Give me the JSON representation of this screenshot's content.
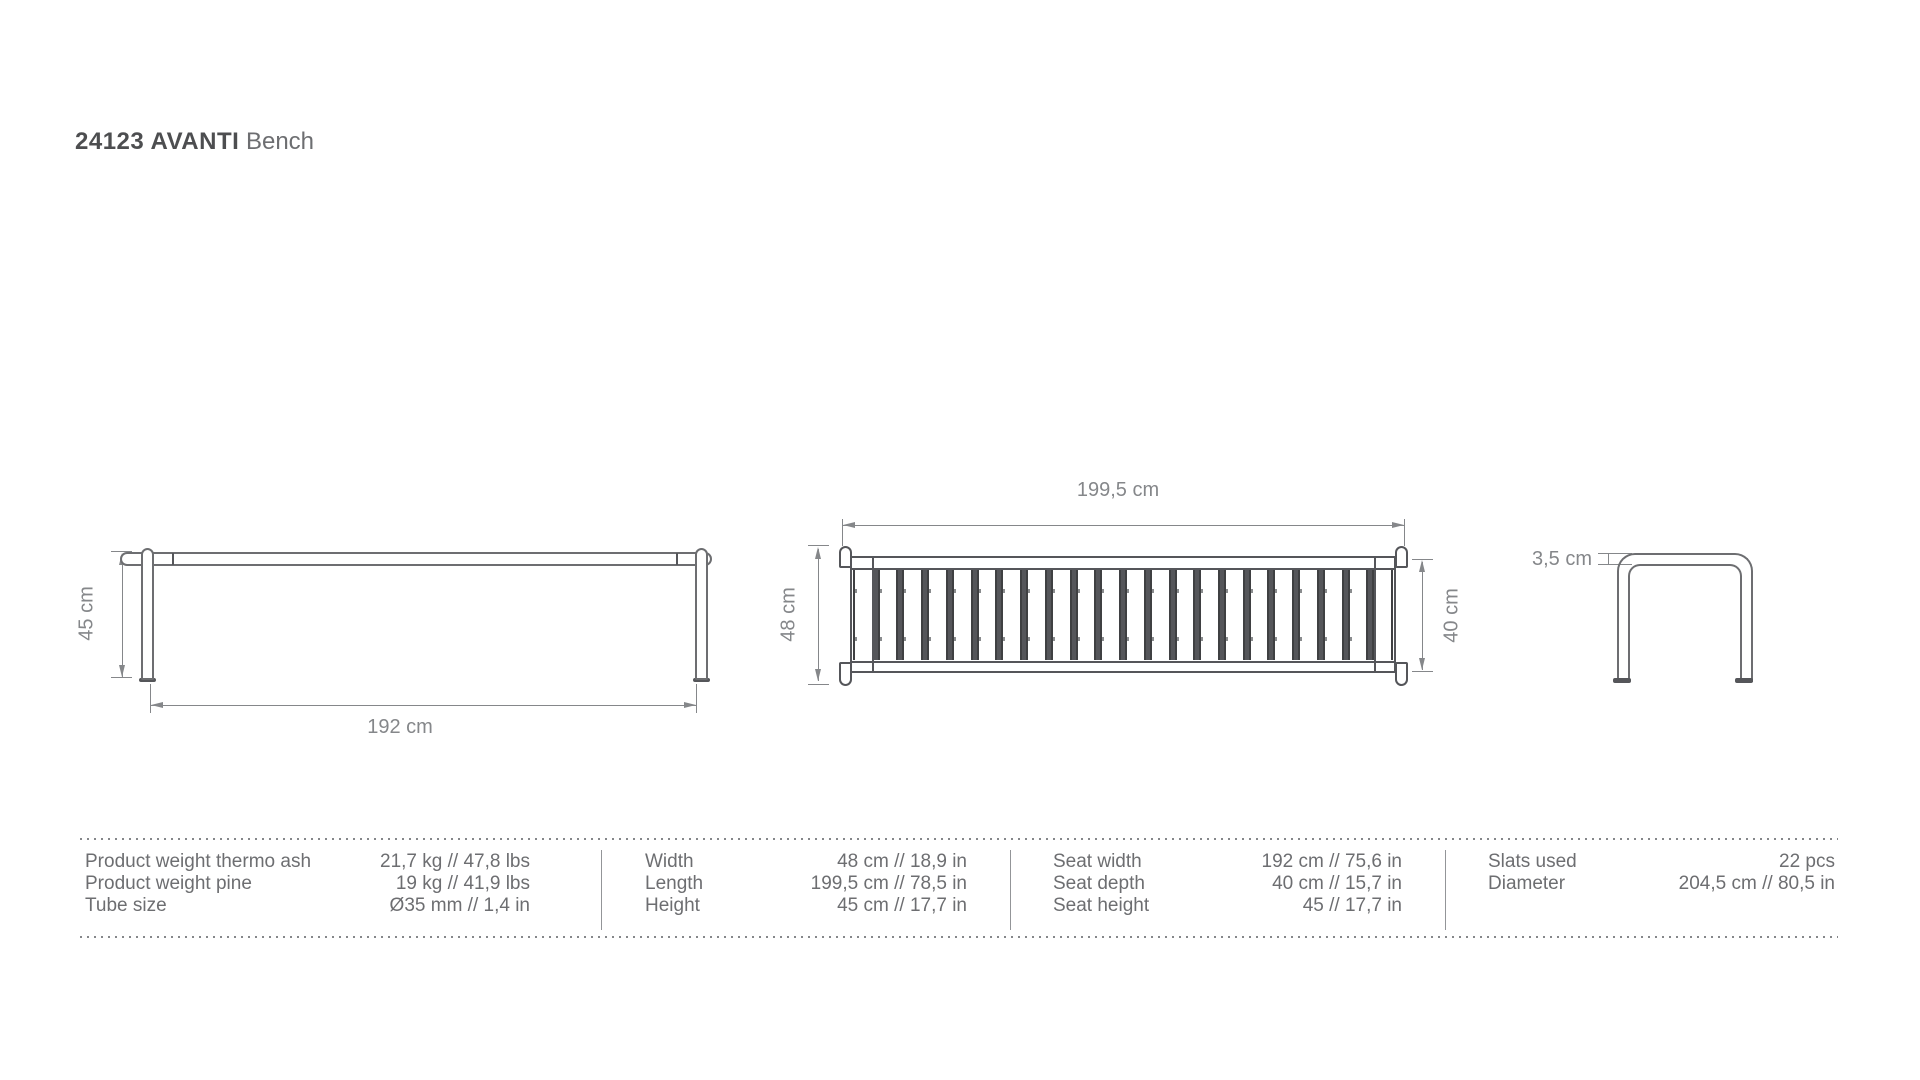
{
  "title": {
    "product_code": "24123 AVANTI",
    "product_type": "Bench"
  },
  "drawings": {
    "side_view": {
      "height_dim_label": "45 cm",
      "width_dim_label": "192 cm"
    },
    "top_view": {
      "length_dim_label": "199,5 cm",
      "overall_depth_dim_label": "48 cm",
      "seat_depth_dim_label": "40 cm",
      "slat_count": 22
    },
    "end_view": {
      "tube_dim_label": "3,5 cm"
    }
  },
  "spec_table": {
    "groups": [
      {
        "rows": [
          {
            "label": "Product weight thermo ash",
            "value": "21,7 kg // 47,8 lbs"
          },
          {
            "label": "Product weight pine",
            "value": "19 kg // 41,9 lbs"
          },
          {
            "label": "Tube size",
            "value": "Ø35 mm // 1,4 in"
          }
        ]
      },
      {
        "rows": [
          {
            "label": "Width",
            "value": "48 cm // 18,9 in"
          },
          {
            "label": "Length",
            "value": "199,5 cm // 78,5 in"
          },
          {
            "label": "Height",
            "value": "45 cm // 17,7 in"
          }
        ]
      },
      {
        "rows": [
          {
            "label": "Seat width",
            "value": "192 cm // 75,6 in"
          },
          {
            "label": "Seat depth",
            "value": "40 cm // 15,7 in"
          },
          {
            "label": "Seat height",
            "value": "45 // 17,7 in"
          }
        ]
      },
      {
        "rows": [
          {
            "label": "Slats used",
            "value": "22 pcs"
          },
          {
            "label": "Diameter",
            "value": "204,5 cm // 80,5 in"
          }
        ]
      }
    ]
  },
  "colors": {
    "line_dark": "#55565a",
    "line_mid": "#6d6e71",
    "dim_gray": "#85878a",
    "text_gray": "#6d6e71",
    "title_dark": "#4d4e50"
  }
}
